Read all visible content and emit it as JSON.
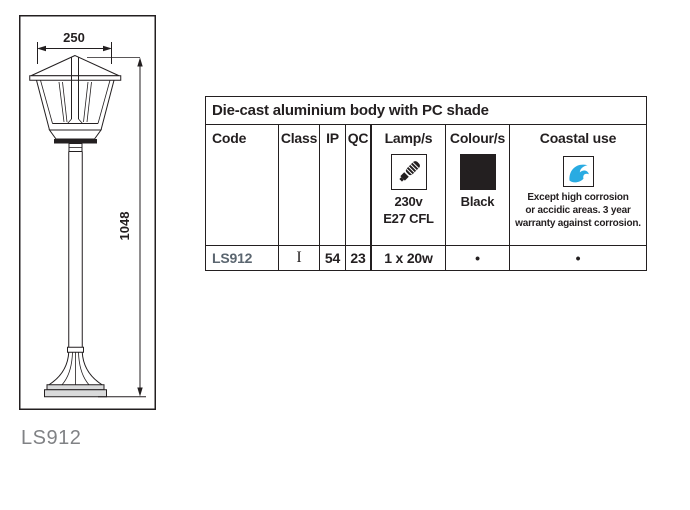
{
  "drawing": {
    "width_dim": "250",
    "height_dim": "1048",
    "caption": "LS912"
  },
  "table": {
    "title": "Die-cast aluminium body with PC shade",
    "columns": {
      "code": "Code",
      "class": "Class",
      "ip": "IP",
      "qc": "QC",
      "lamps": "Lamp/s",
      "colours": "Colour/s",
      "coastal": "Coastal use"
    },
    "lamp_spec": {
      "line1": "230v",
      "line2": "E27 CFL"
    },
    "colour_spec": {
      "name": "Black",
      "swatch_hex": "#231f20"
    },
    "coastal_note": {
      "line1": "Except high corrosion",
      "line2": "or accidic areas. 3 year",
      "line3": "warranty against corrosion."
    },
    "row": {
      "code": "LS912",
      "class": "I",
      "ip": "54",
      "qc": "23",
      "lamps": "1 x 20w",
      "colours_dot": "•",
      "coastal_dot": "•"
    }
  },
  "colors": {
    "line_black": "#231f20",
    "code_grey": "#5b6670",
    "caption_grey": "#808285",
    "wave_blue": "#29abe2",
    "swatch_black": "#231f20"
  }
}
